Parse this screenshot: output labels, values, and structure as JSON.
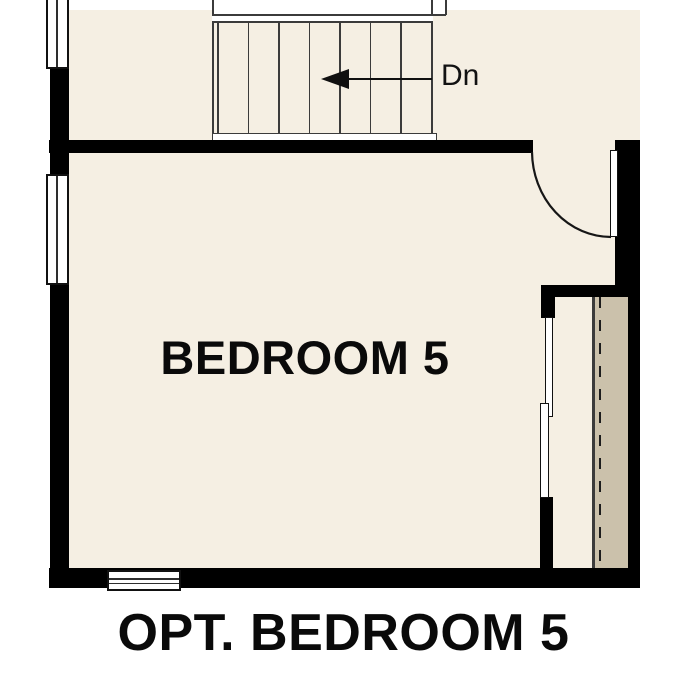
{
  "plan": {
    "title": "OPT. BEDROOM 5",
    "room": {
      "label": "BEDROOM 5"
    },
    "stairs": {
      "label": "Dn",
      "visible_steps": 7,
      "arrow_direction": "left"
    },
    "colors": {
      "floor": "#f5efe3",
      "closet_strip": "#cbc1ab",
      "wall": "#000000",
      "background": "#ffffff",
      "line": "#3b3b3b"
    }
  }
}
